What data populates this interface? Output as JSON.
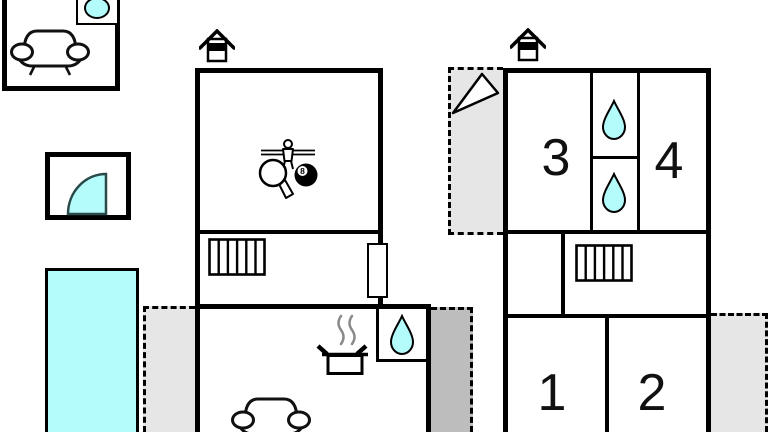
{
  "title": "Holiday home floor plan",
  "colors": {
    "bg": "#ffffff",
    "wall": "#000000",
    "water": "#b4fbfb",
    "terrace-light": "#e6e6e6",
    "terrace-dark": "#bdbdbd",
    "steam": "#8a8a8a",
    "shower-border": "#2a4a4a"
  },
  "rooms": {
    "bedroom3": "3",
    "bedroom4": "4",
    "bedroom1": "1",
    "bedroom2": "2"
  },
  "icons": {
    "billiard_ball_number": "8",
    "legend": {
      "chimney": "chimney-icon",
      "water_drop": "bathroom-water-drop-icon",
      "radiator": "radiator-icon",
      "sofa": "sofa-icon",
      "washing_machine": "washing-machine-icon",
      "shower": "shower-quarter-circle-icon",
      "cooking_pot": "cooking-pot-icon",
      "games": "game-room-icons",
      "north_arrow": "north-arrow-icon"
    }
  }
}
